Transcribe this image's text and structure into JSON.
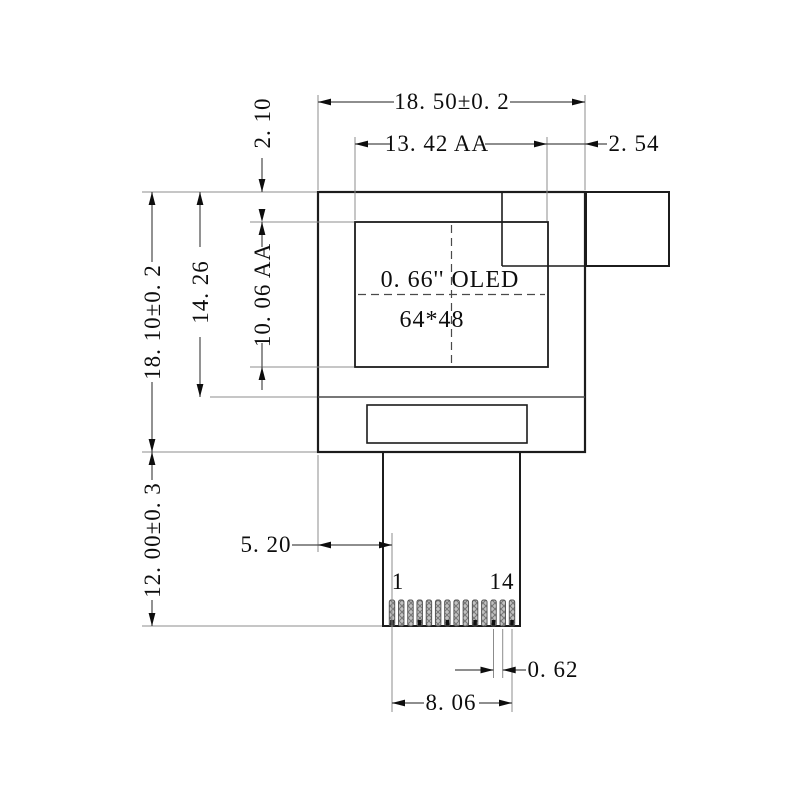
{
  "drawing": {
    "dimensions": {
      "total_width": "18. 50±0. 2",
      "active_area_width": "13. 42 AA",
      "right_margin": "2. 54",
      "top_margin": "2. 10",
      "active_area_height": "10. 06 AA",
      "glass_height": "14. 26",
      "total_height": "18. 10±0. 2",
      "tab_height": "12. 00±0. 3",
      "tab_left_offset": "5. 20",
      "pin_pitch": "0. 62",
      "pin_row_width": "8. 06"
    },
    "display_label": {
      "line1": "0. 66'' OLED",
      "line2": "64*48"
    },
    "pins": {
      "count": 14,
      "first_pin_label": "1",
      "last_pin_label": "14"
    },
    "colors": {
      "outline": "#1c1c1c",
      "dimension_line": "#4a4a4a",
      "extension_line": "#8c8c8c",
      "hatch_fill": "#c2c2c2",
      "hatch_stroke": "#787878"
    }
  }
}
